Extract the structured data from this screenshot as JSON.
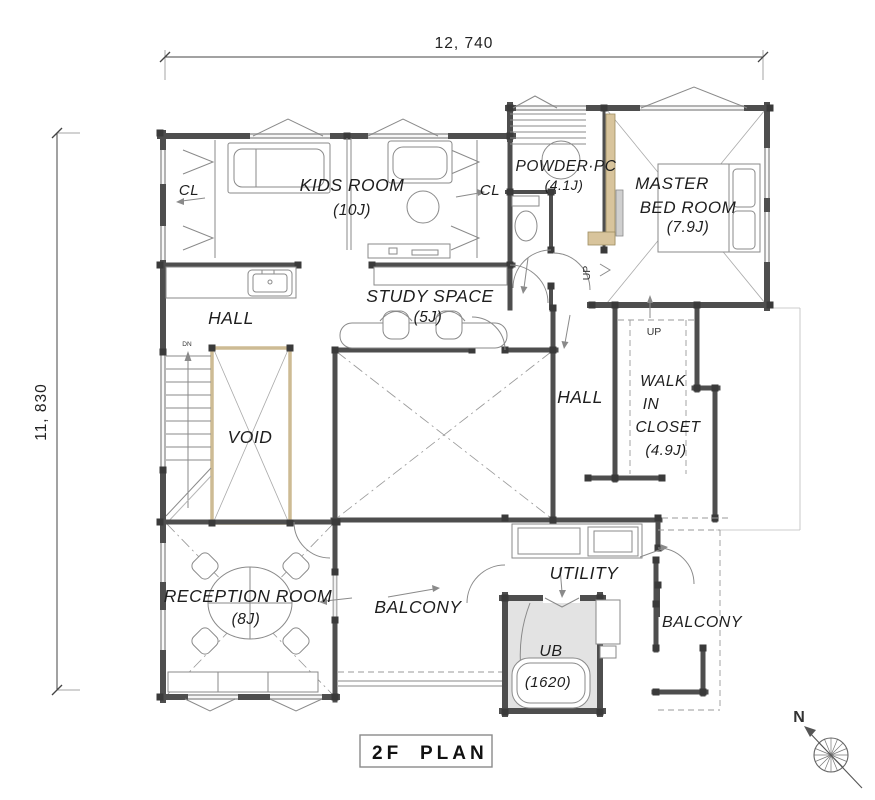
{
  "title": {
    "part1": "2F",
    "part2": "PLAN"
  },
  "dimensions": {
    "top": "12, 740",
    "left": "11, 830"
  },
  "compass": {
    "north": "N"
  },
  "rooms": {
    "cl_left": "CL",
    "cl_right": "CL",
    "kids": {
      "name": "KIDS ROOM",
      "size": "(10J)"
    },
    "powder": {
      "name": "POWDER·PC",
      "size": "(4.1J)"
    },
    "master": {
      "l1": "MASTER",
      "l2": "BED ROOM",
      "size": "(7.9J)"
    },
    "hall_nw": "HALL",
    "study": {
      "name": "STUDY SPACE",
      "size": "(5J)"
    },
    "void": "VOID",
    "hall_e": "HALL",
    "wic": {
      "l1": "WALK",
      "l2": "IN",
      "l3": "CLOSET",
      "size": "(4.9J)"
    },
    "reception": {
      "name": "RECEPTION ROOM",
      "size": "(8J)"
    },
    "balcony_s": "BALCONY",
    "utility": "UTILITY",
    "ub": {
      "name": "UB",
      "size": "(1620)"
    },
    "balcony_se": "BALCONY"
  },
  "annotations": {
    "up_hall": "UP",
    "up_wic": "UP",
    "dn": "DN"
  },
  "colors": {
    "background": "#ffffff",
    "wall": "#4e4e4e",
    "wall_light": "#b3b3b3",
    "post": "#3a3a3a",
    "accent": "#d8c49c",
    "ub_fill": "#e3e3e3",
    "line": "#8a8a8a",
    "text": "#1e1e1e"
  }
}
